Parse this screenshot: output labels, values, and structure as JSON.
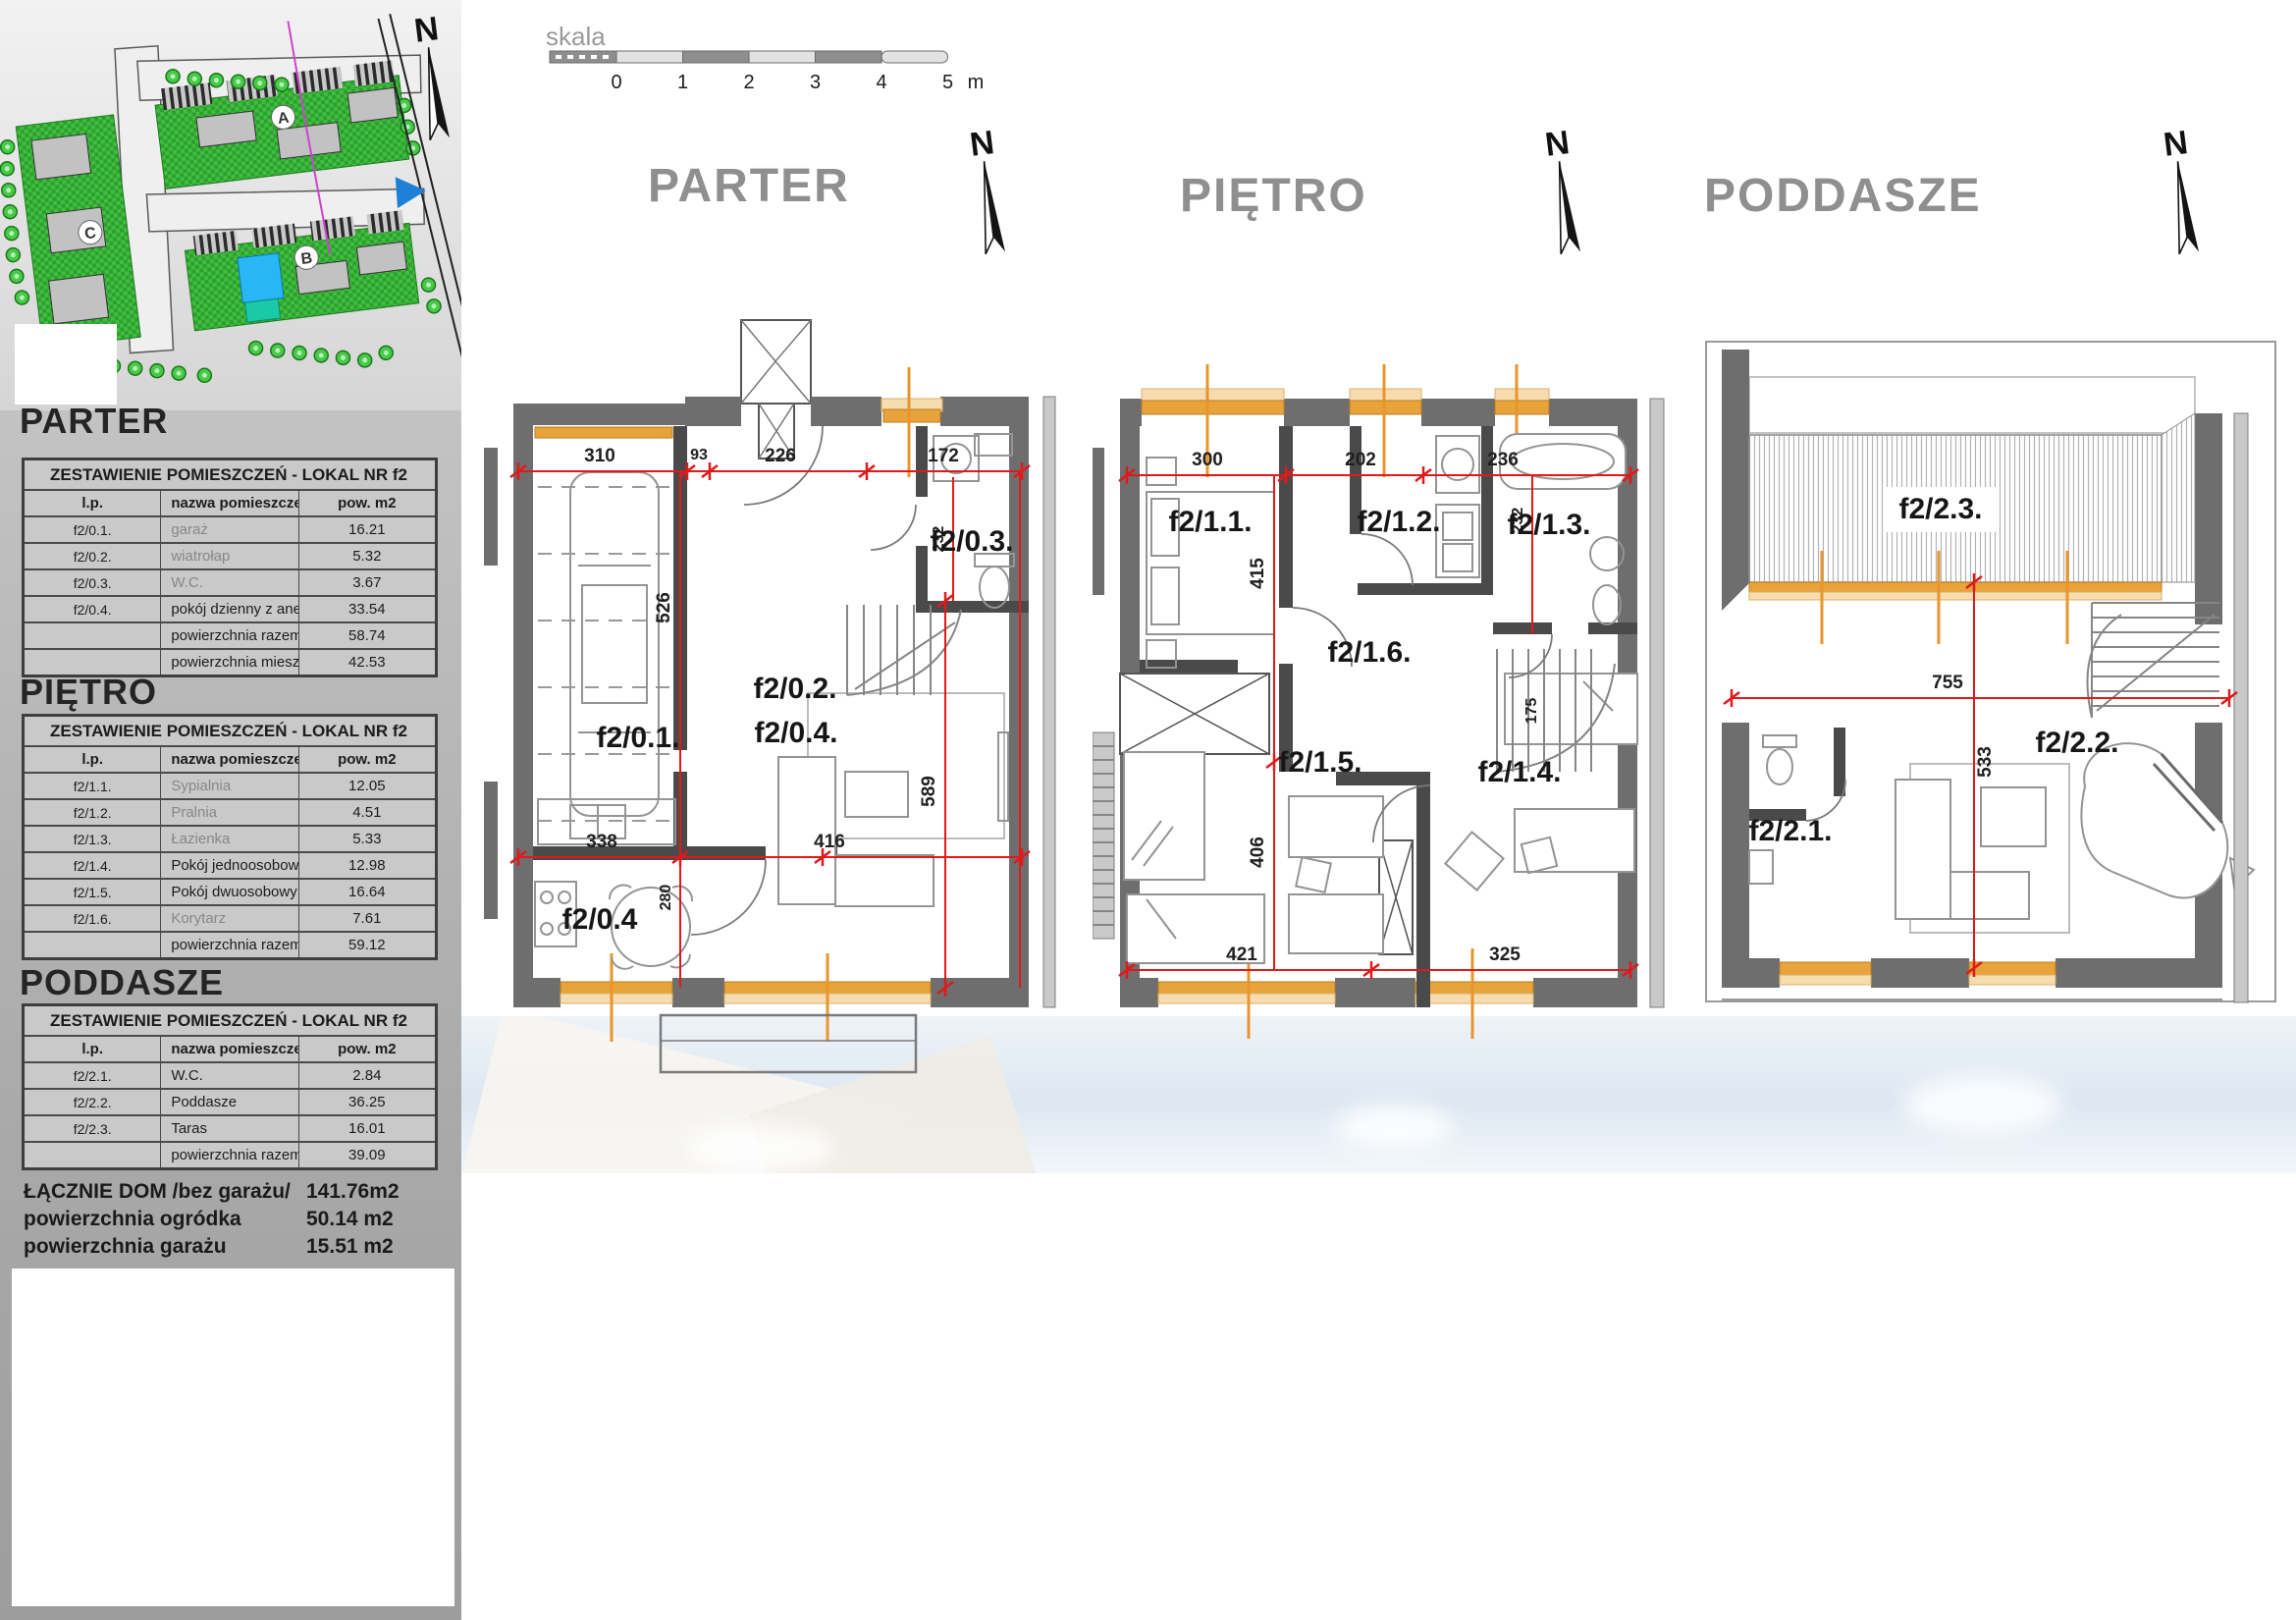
{
  "site": {
    "north": "N",
    "labels": {
      "a": "A",
      "b": "B",
      "c": "C"
    }
  },
  "scalebar": {
    "label": "skala",
    "ticks": [
      "0",
      "1",
      "2",
      "3",
      "4",
      "5"
    ],
    "unit": "m"
  },
  "plans": {
    "parter": {
      "title": "PARTER",
      "north": "N",
      "rooms": {
        "garage": "f2/0.1.",
        "entry": "f2/0.2.",
        "wc": "f2/0.3.",
        "living": "f2/0.4.",
        "kitchen": "f2/0.4"
      },
      "dims": {
        "top1": "310",
        "top2": "93",
        "top3": "226",
        "top4": "172",
        "garage_depth": "526",
        "living_depth": "589",
        "mid1": "338",
        "mid2": "416",
        "kitchen_depth": "280",
        "wc_depth": "232"
      }
    },
    "pietro": {
      "title": "PIĘTRO",
      "north": "N",
      "rooms": {
        "r11": "f2/1.1.",
        "r12": "f2/1.2.",
        "r13": "f2/1.3.",
        "r14": "f2/1.4.",
        "r15": "f2/1.5.",
        "r16": "f2/1.6."
      },
      "dims": {
        "top1": "300",
        "top2": "202",
        "top3": "236",
        "left_up": "415",
        "left_dn": "406",
        "right": "232",
        "stairs": "175",
        "bot1": "421",
        "bot2": "325"
      }
    },
    "poddasze": {
      "title": "PODDASZE",
      "north": "N",
      "rooms": {
        "wc": "f2/2.1.",
        "attic": "f2/2.2.",
        "terrace": "f2/2.3."
      },
      "dims": {
        "width": "755",
        "height": "533"
      }
    }
  },
  "sidebar": {
    "sections": [
      {
        "heading": "PARTER",
        "table": {
          "title": "ZESTAWIENIE POMIESZCZEŃ - LOKAL NR f2",
          "headers": [
            "l.p.",
            "nazwa pomieszczenia",
            "pow. m2"
          ],
          "rows": [
            {
              "lp": "f2/0.1.",
              "name": "garaż",
              "area": "16.21"
            },
            {
              "lp": "f2/0.2.",
              "name": "wiatrołap",
              "area": "5.32"
            },
            {
              "lp": "f2/0.3.",
              "name": "W.C.",
              "area": "3.67"
            },
            {
              "lp": "f2/0.4.",
              "name": "pokój dzienny z aneksem kuchennym",
              "area": "33.54"
            },
            {
              "lp": "",
              "name": "powierzchnia razem",
              "area": "58.74"
            },
            {
              "lp": "",
              "name": "powierzchnia mieszkalna (bez garażu)",
              "area": "42.53"
            }
          ]
        }
      },
      {
        "heading": "PIĘTRO",
        "table": {
          "title": "ZESTAWIENIE POMIESZCZEŃ - LOKAL NR f2",
          "headers": [
            "l.p.",
            "nazwa pomieszczenia",
            "pow. m2"
          ],
          "rows": [
            {
              "lp": "f2/1.1.",
              "name": "Sypialnia",
              "area": "12.05"
            },
            {
              "lp": "f2/1.2.",
              "name": "Pralnia",
              "area": "4.51"
            },
            {
              "lp": "f2/1.3.",
              "name": "Łazienka",
              "area": "5.33"
            },
            {
              "lp": "f2/1.4.",
              "name": "Pokój jednoosobowy",
              "area": "12.98"
            },
            {
              "lp": "f2/1.5.",
              "name": "Pokój dwuosobowy",
              "area": "16.64"
            },
            {
              "lp": "f2/1.6.",
              "name": "Korytarz",
              "area": "7.61"
            },
            {
              "lp": "",
              "name": "powierzchnia razem",
              "area": "59.12"
            }
          ]
        }
      },
      {
        "heading": "PODDASZE",
        "table": {
          "title": "ZESTAWIENIE POMIESZCZEŃ - LOKAL NR f2",
          "headers": [
            "l.p.",
            "nazwa pomieszczenia",
            "pow. m2"
          ],
          "rows": [
            {
              "lp": "f2/2.1.",
              "name": "W.C.",
              "area": "2.84"
            },
            {
              "lp": "f2/2.2.",
              "name": "Poddasze",
              "area": "36.25"
            },
            {
              "lp": "f2/2.3.",
              "name": "Taras",
              "area": "16.01"
            },
            {
              "lp": "",
              "name": "powierzchnia razem bez tarasu",
              "area": "39.09"
            }
          ]
        }
      }
    ],
    "totals": [
      {
        "label": "ŁĄCZNIE DOM /bez garażu/",
        "value": "141.76m2"
      },
      {
        "label": "powierzchnia ogródka",
        "value": "50.14 m2"
      },
      {
        "label": "powierzchnia garażu",
        "value": "15.51 m2"
      }
    ]
  }
}
